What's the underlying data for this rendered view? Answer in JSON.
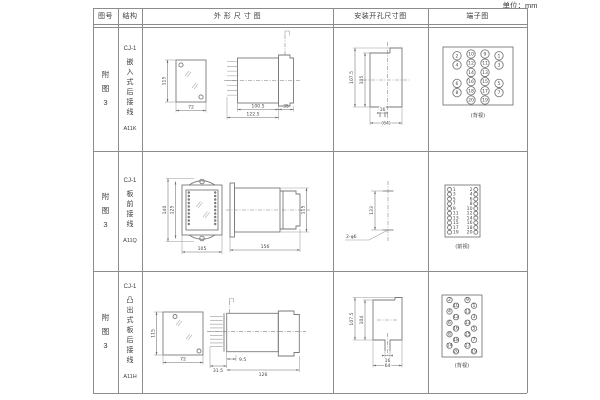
{
  "unit_label": "单位：mm",
  "table": {
    "headers": {
      "fig_no": "图号",
      "structure": "结构",
      "outline": "外 形 尺 寸 图",
      "install": "安装开孔尺寸图",
      "terminal": "端子图"
    },
    "rows": [
      {
        "fig_no": "附图3",
        "model": "CJ-1",
        "structure_name": "嵌入式后接线",
        "code": "A11K",
        "outline": {
          "front_h": "115",
          "front_w": "72",
          "body_len": "100.5",
          "flange_w": "35",
          "total_len": "122.5"
        },
        "install": {
          "outer_h": "107.5",
          "inner_h": "105",
          "slot_w": "16",
          "cutout_w": "(64)"
        },
        "terminal": {
          "view_label": "(背视)",
          "grid": [
            [
              "2",
              "10",
              "9",
              "1"
            ],
            [
              "4",
              "12",
              "11",
              "3"
            ],
            [
              "",
              "14",
              "13",
              ""
            ],
            [
              "6",
              "16",
              "15",
              "5"
            ],
            [
              "8",
              "18",
              "17",
              "7"
            ],
            [
              "",
              "20",
              "19",
              ""
            ]
          ]
        }
      },
      {
        "fig_no": "附图3",
        "model": "CJ-1",
        "structure_name": "板前接线",
        "code": "A11Q",
        "outline": {
          "outer_h": "140",
          "hole_dist_v": "125",
          "front_w": "105",
          "body_len": "156",
          "side_h": "115"
        },
        "install": {
          "hole_dist": "133",
          "holes_label": "2-φ6"
        },
        "terminal": {
          "view_label": "(前视)",
          "pairs": [
            [
              "1",
              "2"
            ],
            [
              "3",
              "4"
            ],
            [
              "5",
              "6"
            ],
            [
              "7",
              "8"
            ],
            [
              "9",
              "10"
            ],
            [
              "11",
              "12"
            ],
            [
              "13",
              "14"
            ],
            [
              "15",
              "16"
            ],
            [
              "17",
              "18"
            ],
            [
              "19",
              "20"
            ]
          ]
        }
      },
      {
        "fig_no": "附图3",
        "model": "CJ-1",
        "structure_name": "凸出式板后接线",
        "code": "A11H",
        "outline": {
          "front_h": "115",
          "front_w": "72",
          "stud_len": "31.5",
          "gap": "9.5",
          "body_len": "126"
        },
        "install": {
          "outer_h": "107.5",
          "inner_h": "104",
          "slot_w": "16",
          "cutout_w": "64"
        },
        "terminal": {
          "view_label": "(背视)",
          "groups": [
            [
              "2",
              "10",
              "4",
              "12",
              "6",
              "16",
              "8",
              "18",
              "14",
              "20"
            ],
            [
              "9",
              "1",
              "11",
              "3",
              "13",
              "5",
              "15",
              "7",
              "17",
              "19"
            ]
          ]
        }
      }
    ]
  }
}
